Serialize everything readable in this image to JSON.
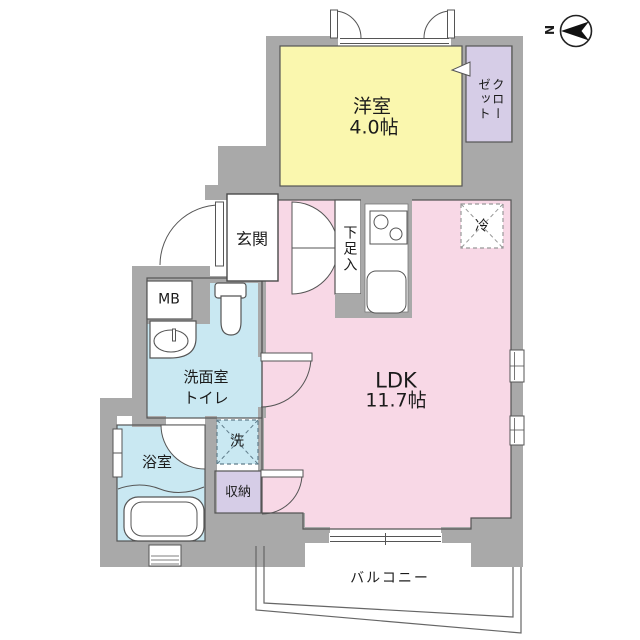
{
  "title": "floor-plan",
  "colors": {
    "wall": "#A9A9A9",
    "western_room": "#FAF7AE",
    "ldk": "#F8D8E6",
    "wet_area": "#C9E8F2",
    "closet": "#D6CDE7",
    "outline": "#555555",
    "text": "#1B1B1B"
  },
  "rooms": {
    "western_room": {
      "name": "洋室",
      "area": "4.0帖"
    },
    "ldk": {
      "name": "LDK",
      "area": "11.7帖"
    },
    "closet": {
      "name": "クローゼット"
    },
    "entrance": {
      "name": "玄関"
    },
    "shoe_cabinet": {
      "name": "下足入"
    },
    "meter_box": {
      "name": "MB"
    },
    "washroom": {
      "line1": "洗面室",
      "line2": "トイレ"
    },
    "bathroom": {
      "name": "浴室"
    },
    "storage": {
      "name": "収納"
    },
    "balcony": {
      "name": "バルコニー"
    },
    "refrigerator": {
      "name": "冷"
    },
    "washing_machine": {
      "name": "洗"
    }
  },
  "compass": {
    "label": "N"
  }
}
